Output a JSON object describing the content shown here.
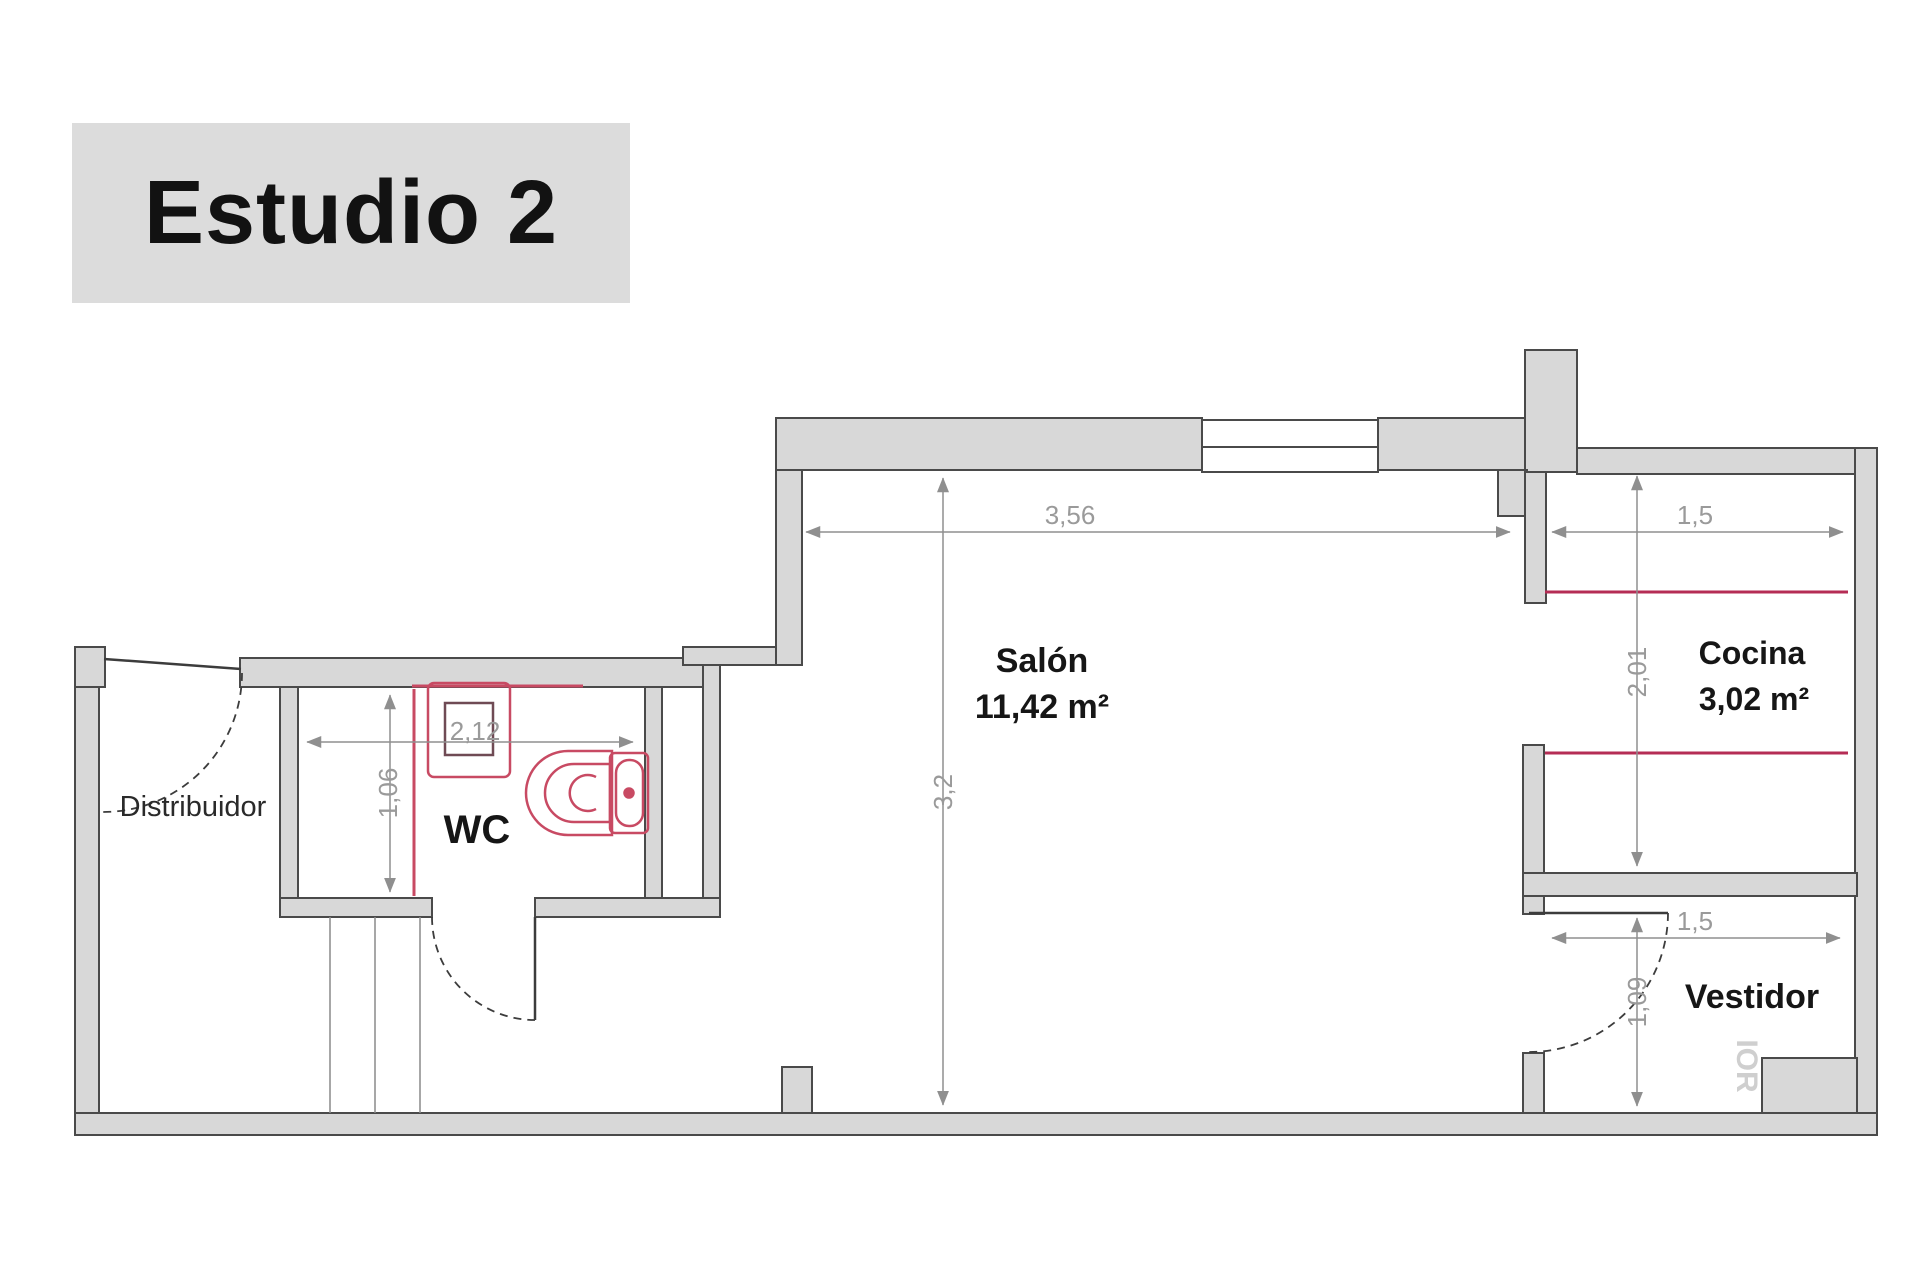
{
  "title": "Estudio 2",
  "rooms": {
    "distribuidor": {
      "label": "Distribuidor"
    },
    "wc": {
      "label": "WC"
    },
    "salon": {
      "label": "Salón",
      "area": "11,42 m²"
    },
    "cocina": {
      "label": "Cocina",
      "area": "3,02 m²"
    },
    "vestidor": {
      "label": "Vestidor"
    }
  },
  "dimensions": {
    "wc_width": "2,12",
    "wc_depth": "1,06",
    "salon_width": "3,56",
    "salon_depth": "3,2",
    "cocina_width": "1,5",
    "cocina_depth": "2,01",
    "vestidor_width": "1,5",
    "vestidor_depth": "1,09"
  },
  "watermark_fragment": "IOR",
  "colors": {
    "wall_fill": "#d8d8d8",
    "wall_outline": "#4a4a4a",
    "dimension": "#8f8f8f",
    "fixture_red": "#c84a63",
    "fixture_dark": "#6f4a54",
    "counter_red": "#b52d55",
    "accent_pink": "#e58b9d",
    "title_bg": "#dcdcdc"
  }
}
